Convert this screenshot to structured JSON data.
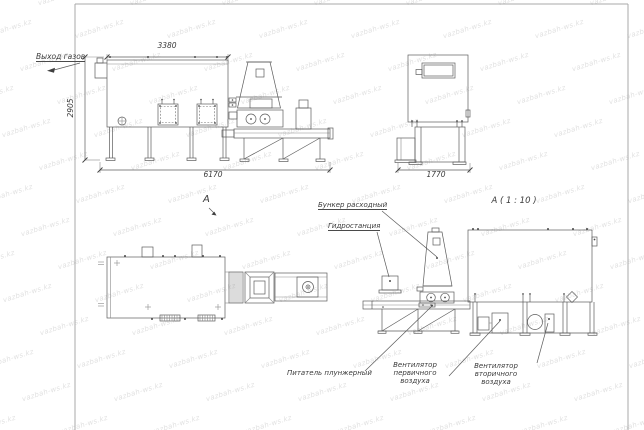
{
  "watermark": {
    "text": "vazbah-ws.kz"
  },
  "dimensions": {
    "front_top_width": "3380",
    "front_height": "2905",
    "front_overall_width": "6170",
    "end_width": "1770"
  },
  "labels": {
    "gas_outlet": "Выход газов",
    "section_mark": "А",
    "detail_title": "А ( 1 : 10 )",
    "hopper": "Бункер расходный",
    "hydro_station": "Гидростанция",
    "plunger_feeder": "Питатель плунжерный",
    "primary_fan": "Вентилятор первичного воздуха",
    "secondary_fan": "Вентилятор вторичного воздуха"
  },
  "colors": {
    "line": "#5c5c5c",
    "text": "#3a3a3a",
    "watermark": "#bdbdbd",
    "frame": "#a8a8a8"
  }
}
